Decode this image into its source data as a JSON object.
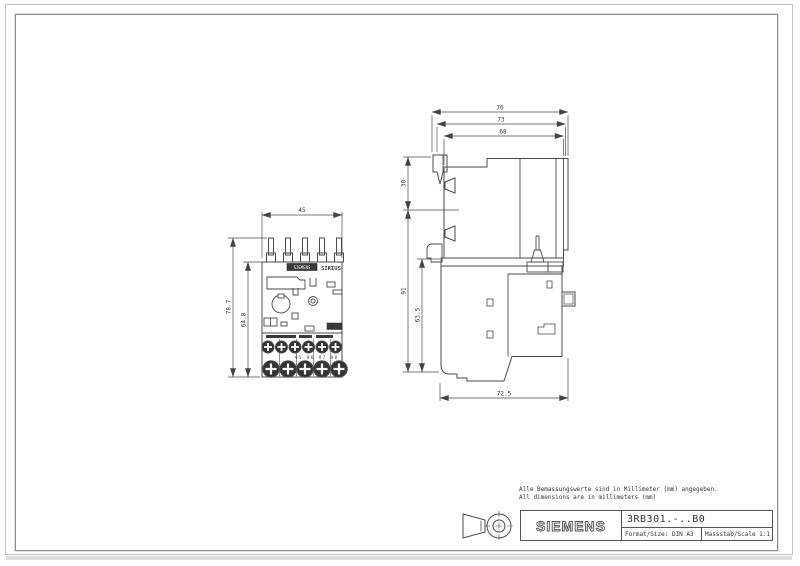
{
  "title_block": {
    "company_logo": "SIEMENS",
    "part_number": "3RB301.-..B0",
    "format_label": "Format/Size: DIN A3",
    "scale_label": "Massstab/Scale 1:1"
  },
  "notes": {
    "de": "Alle Bemassungswerte sind in Millimeter (mm) angegeben.",
    "en": "All dimensions are in millimeters (mm)"
  },
  "front_view": {
    "dims": {
      "width": "45",
      "height_total": "78.7",
      "height_body": "64.8"
    },
    "labels": {
      "brand": "SIEMENS",
      "series": "SIRIUS",
      "model": "3RB30",
      "terminals": "95 96 97 98"
    }
  },
  "side_view": {
    "dims": {
      "depth_total": "76",
      "depth_mid": "73",
      "depth_body": "68",
      "top_section": "30",
      "height_total": "91",
      "height_body": "63.5",
      "depth_base": "72.5"
    }
  },
  "colors": {
    "line": "#4a4a4a",
    "text": "#333333",
    "frame_inner": "#8c8c8c",
    "frame_outer": "#c2c2c2",
    "dark_fill": "#3a3a3a"
  }
}
